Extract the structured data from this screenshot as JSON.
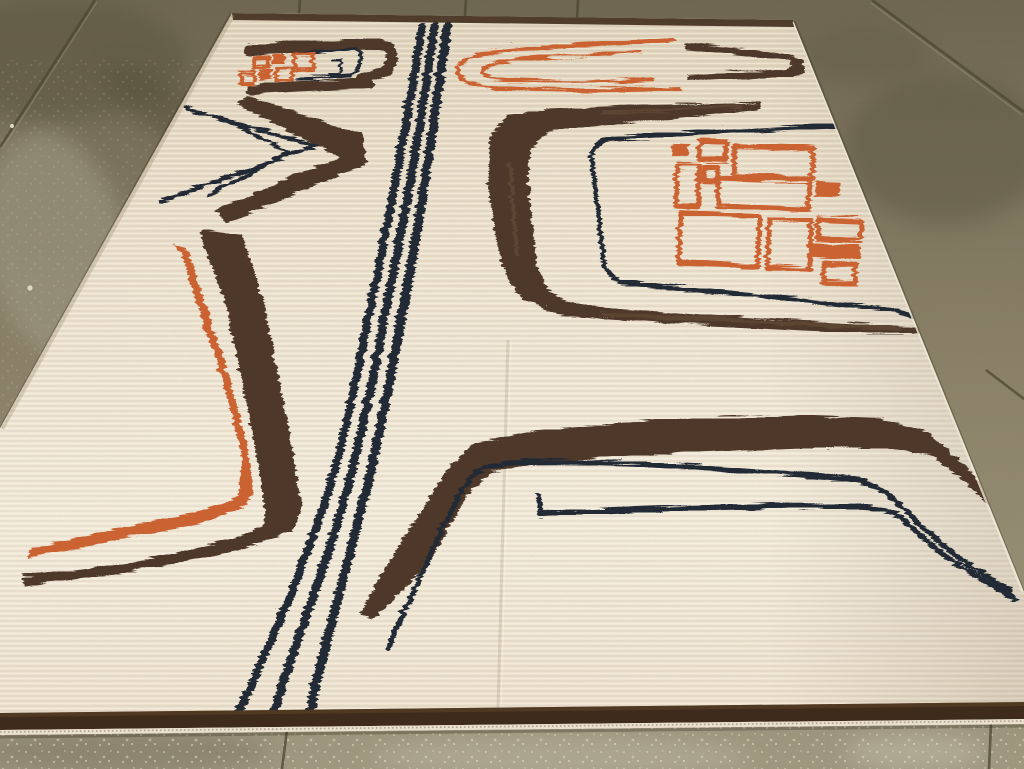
{
  "scene": {
    "type": "photograph",
    "description": "Perspective photograph of a large cream hand-knotted wool rug lying on a wet olive-grey concrete tile floor. The rug bears abstract mid-century motifs in dark chocolate brown, navy-black and burnt orange: three wavy vertical navy stripes down the middle, nested angular chevrons and bracket hooks, a large brown open bracket enclosing a grid of orange rectangles, a double-line orange horseshoe, a long orange-and-brown elbow hook on the left, and a wide brown band with two navy trailing lines across the bottom right. A dark brown selvage strip runs along the bottom edge of the rug."
  },
  "palette": {
    "rug-field": "#ece1cd",
    "rug-field-light": "#f4ecdc",
    "rug-field-dark": "#e0d3ba",
    "rug-brown": "#4e392a",
    "rug-brown-light": "#7d6248",
    "rug-navy": "#232935",
    "rug-orange": "#ca6231",
    "rug-orange-light": "#dd8145",
    "border-brown": "#3f2b1b",
    "fringe": "#e8dfcc",
    "floor-top": "#6e6650",
    "floor-mid": "#8a8167",
    "floor-bottom": "#a29a81",
    "floor-stain": "#5c543d",
    "floor-sheen": "#a49e87",
    "floor-speckle": "#e6dfc9",
    "grout": "#4c4532"
  },
  "rug": {
    "motifs": [
      "triple-vertical-navy-stripes",
      "top-left-orange-grid-with-brown-navy-brackets",
      "left-nested-chevrons-navy-brown",
      "left-orange-brown-elbow-hook",
      "top-right-orange-double-horseshoe",
      "top-right-brown-chevron",
      "right-brown-open-bracket-with-navy-outline",
      "right-orange-rectangle-grid",
      "bottom-right-brown-band-with-two-navy-lines",
      "bottom-brown-selvage-border"
    ]
  },
  "floor": {
    "material": "concrete tile, wet with stains and white speckle aggregate",
    "visible_regions": [
      "top strip",
      "upper-left triangle",
      "upper-right triangle",
      "bottom strip"
    ]
  }
}
